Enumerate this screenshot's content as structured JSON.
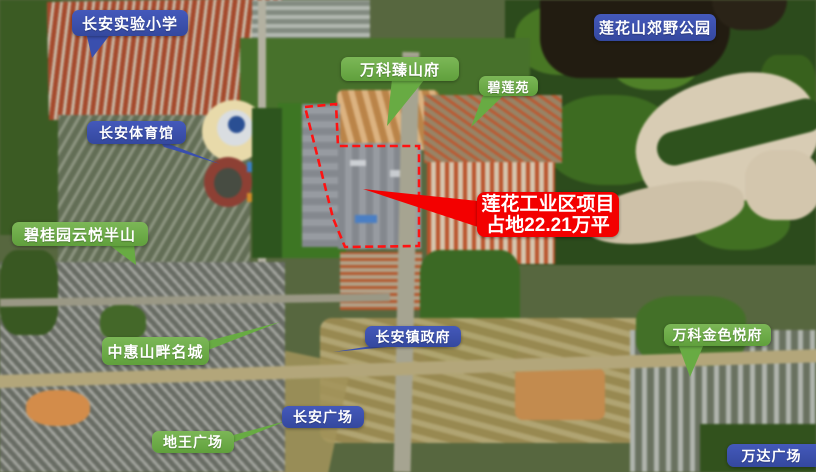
{
  "labels": [
    {
      "text": "长安实验小学",
      "type": "blue"
    },
    {
      "text": "莲花山郊野公园",
      "type": "blue"
    },
    {
      "text": "万科臻山府",
      "type": "green"
    },
    {
      "text": "碧莲苑",
      "type": "green"
    },
    {
      "text": "长安体育馆",
      "type": "blue"
    },
    {
      "text": "碧桂园云悦半山",
      "type": "green"
    },
    {
      "text": "中惠山畔名城",
      "type": "green"
    },
    {
      "text": "长安镇政府",
      "type": "blue"
    },
    {
      "text": "万科金色悦府",
      "type": "green"
    },
    {
      "text": "长安广场",
      "type": "blue"
    },
    {
      "text": "地王广场",
      "type": "green"
    },
    {
      "text": "万达广场",
      "type": "blue"
    }
  ],
  "project_callout": {
    "line1": "莲花工业区项目",
    "line2": "占地22.21万平"
  },
  "colors": {
    "label_blue": "#3a4fae",
    "label_green": "#68ab43",
    "callout_red": "#f30000",
    "boundary_red": "#ff1212"
  }
}
